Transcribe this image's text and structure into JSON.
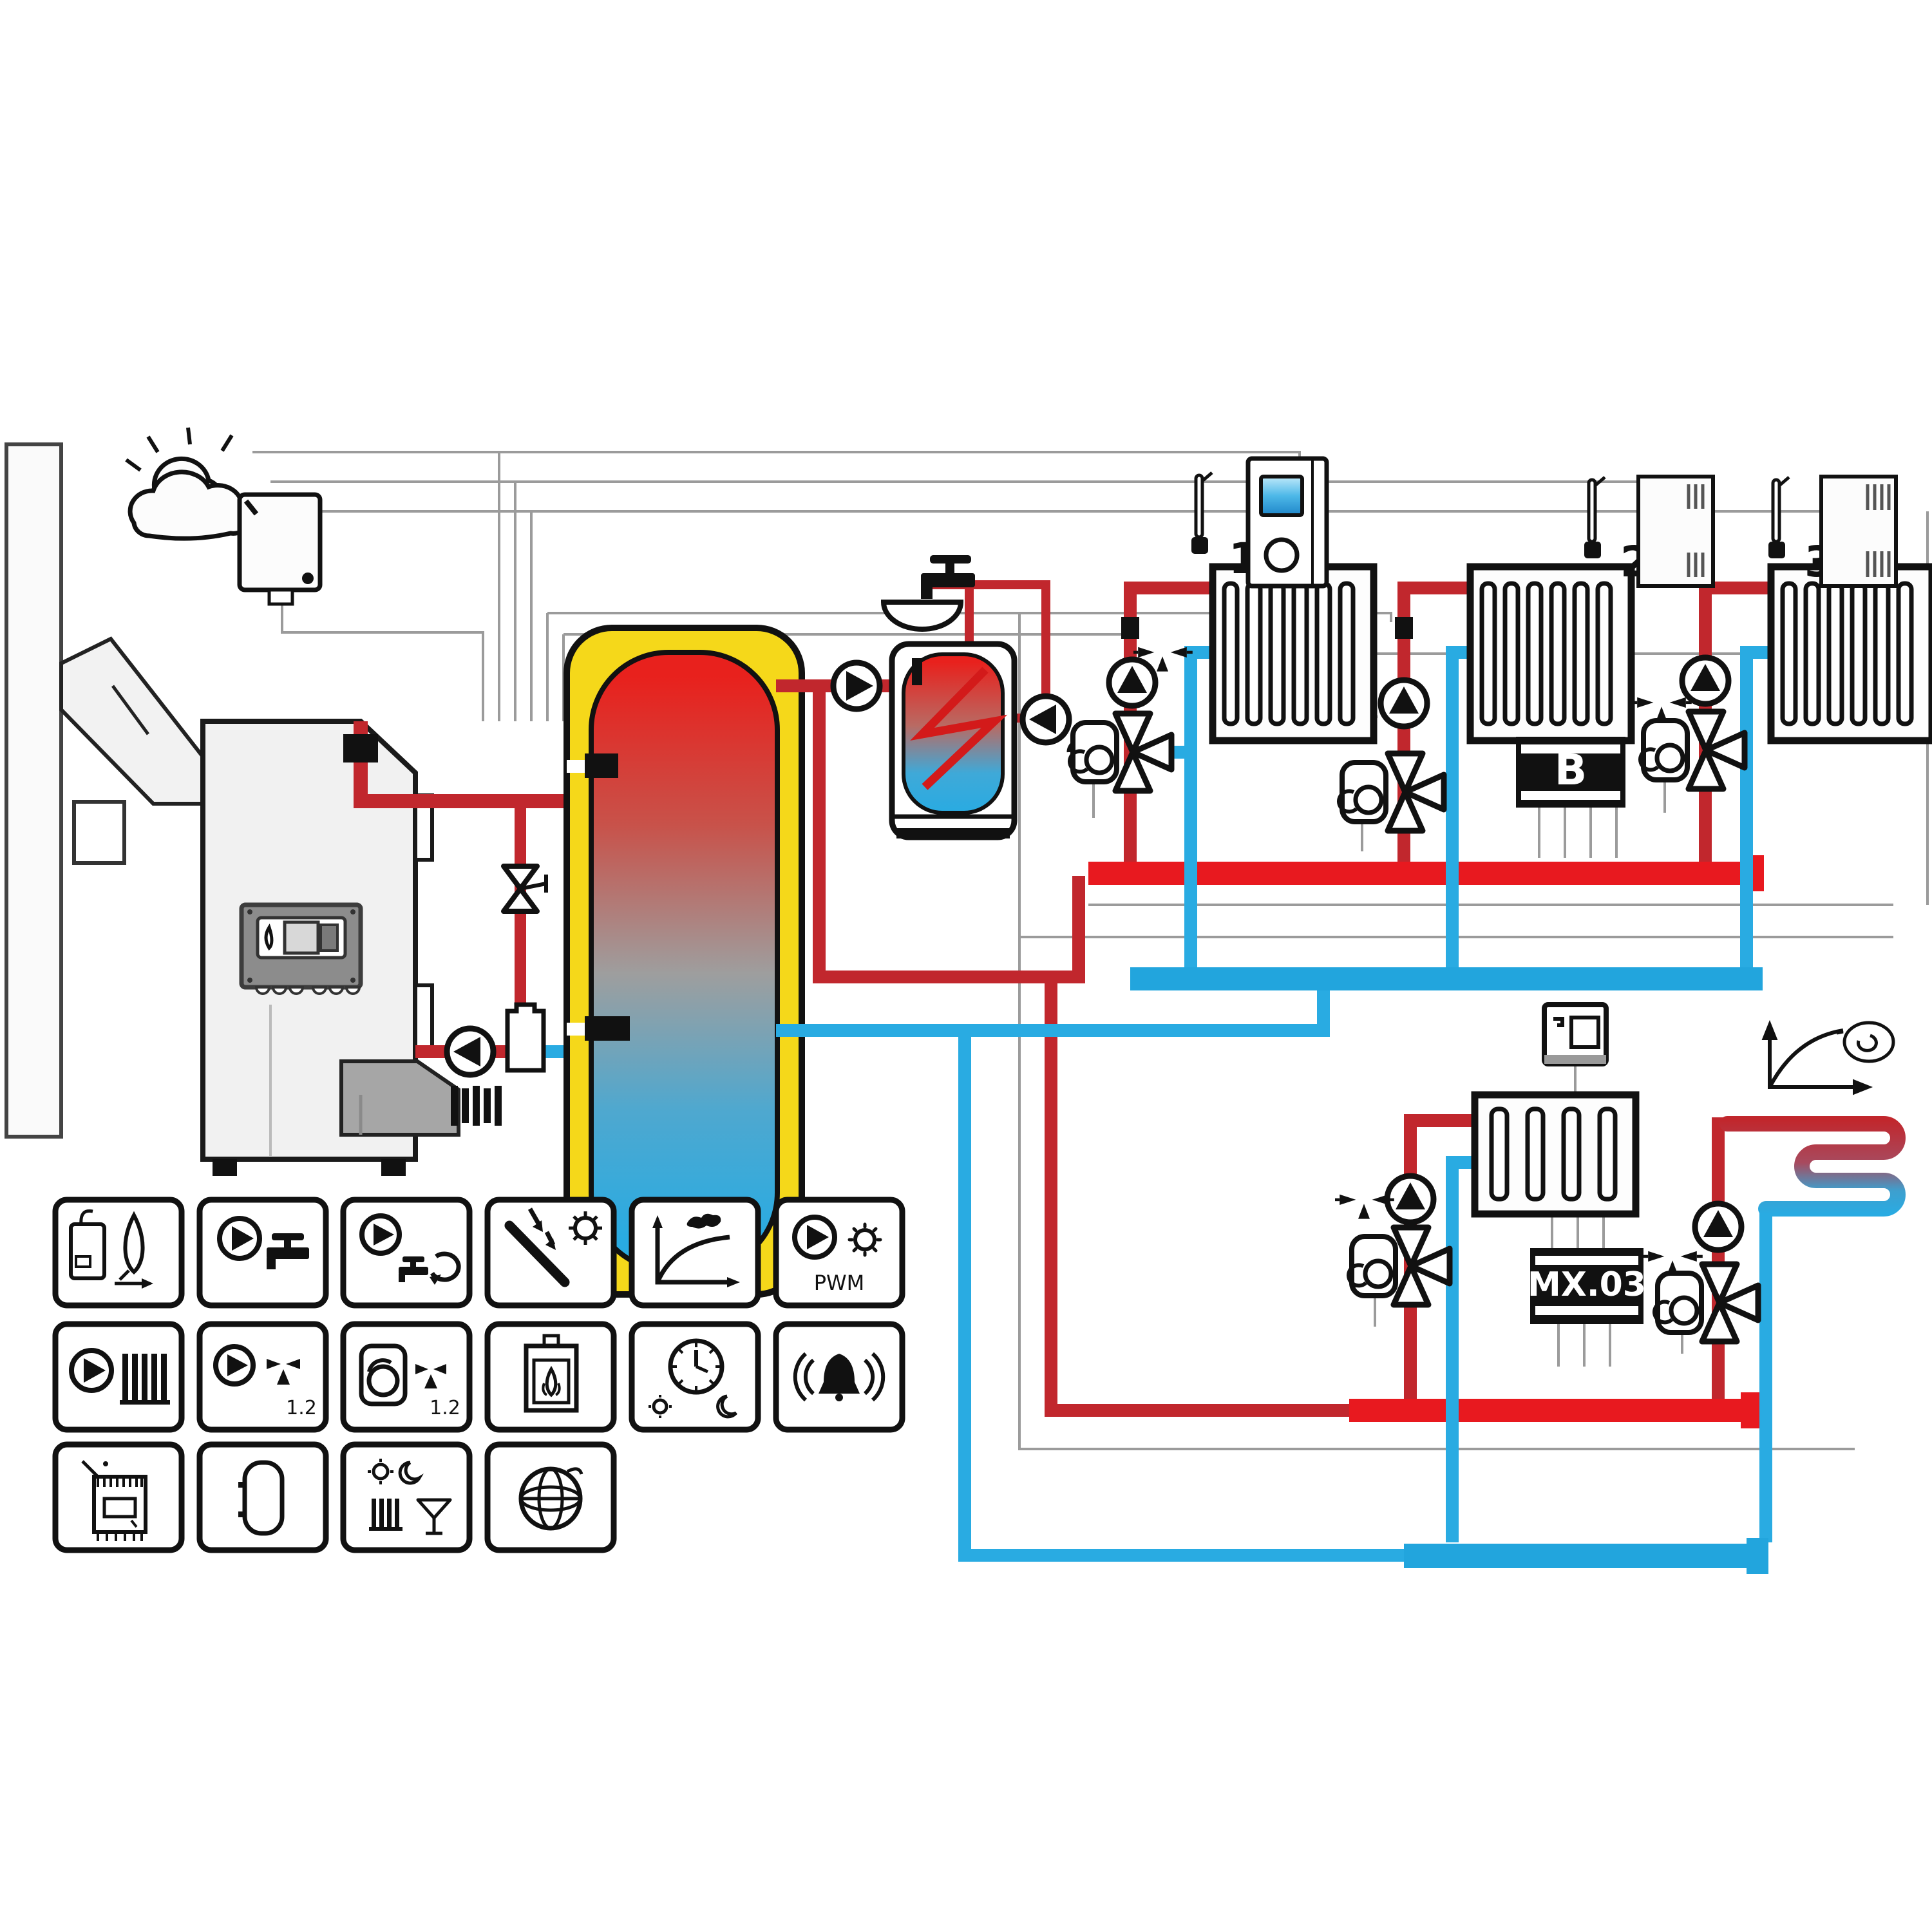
{
  "scheme_title": "heating-system-hydraulic-scheme",
  "colors": {
    "supply_pipe": "#c1272d",
    "supply_manifold": "#e8191f",
    "return_pipe": "#29abe2",
    "return_manifold": "#22a5dd",
    "buffer_insulation": "#f5d81a",
    "signal_wire": "#9b9b9b",
    "outline": "#111111",
    "display_blue": "#4db8e8"
  },
  "zones": {
    "controllers": [
      {
        "label": "1"
      },
      {
        "label": "2"
      },
      {
        "label": "3"
      }
    ]
  },
  "modules": {
    "extension": {
      "label": "B"
    },
    "mixer": {
      "label": "MX.03"
    }
  },
  "legend": {
    "items": [
      {
        "name": "gas-boiler-burner-control"
      },
      {
        "name": "dhw-charging-pump"
      },
      {
        "name": "dhw-circulation-pump"
      },
      {
        "name": "solar-collector-control"
      },
      {
        "name": "weather-compensated-heating-curve"
      },
      {
        "name": "pwm-solar-pump",
        "label": "PWM"
      },
      {
        "name": "heating-circuit-pump"
      },
      {
        "name": "mixed-circuit-pumps",
        "label": "1.2"
      },
      {
        "name": "mixing-valve-actuators",
        "label": "1.2"
      },
      {
        "name": "solid-fuel-boiler"
      },
      {
        "name": "time-program-day-night"
      },
      {
        "name": "alarm-output"
      },
      {
        "name": "electric-heating-element"
      },
      {
        "name": "buffer-tank-management"
      },
      {
        "name": "party-holiday-modes"
      },
      {
        "name": "internet-connectivity"
      }
    ]
  }
}
